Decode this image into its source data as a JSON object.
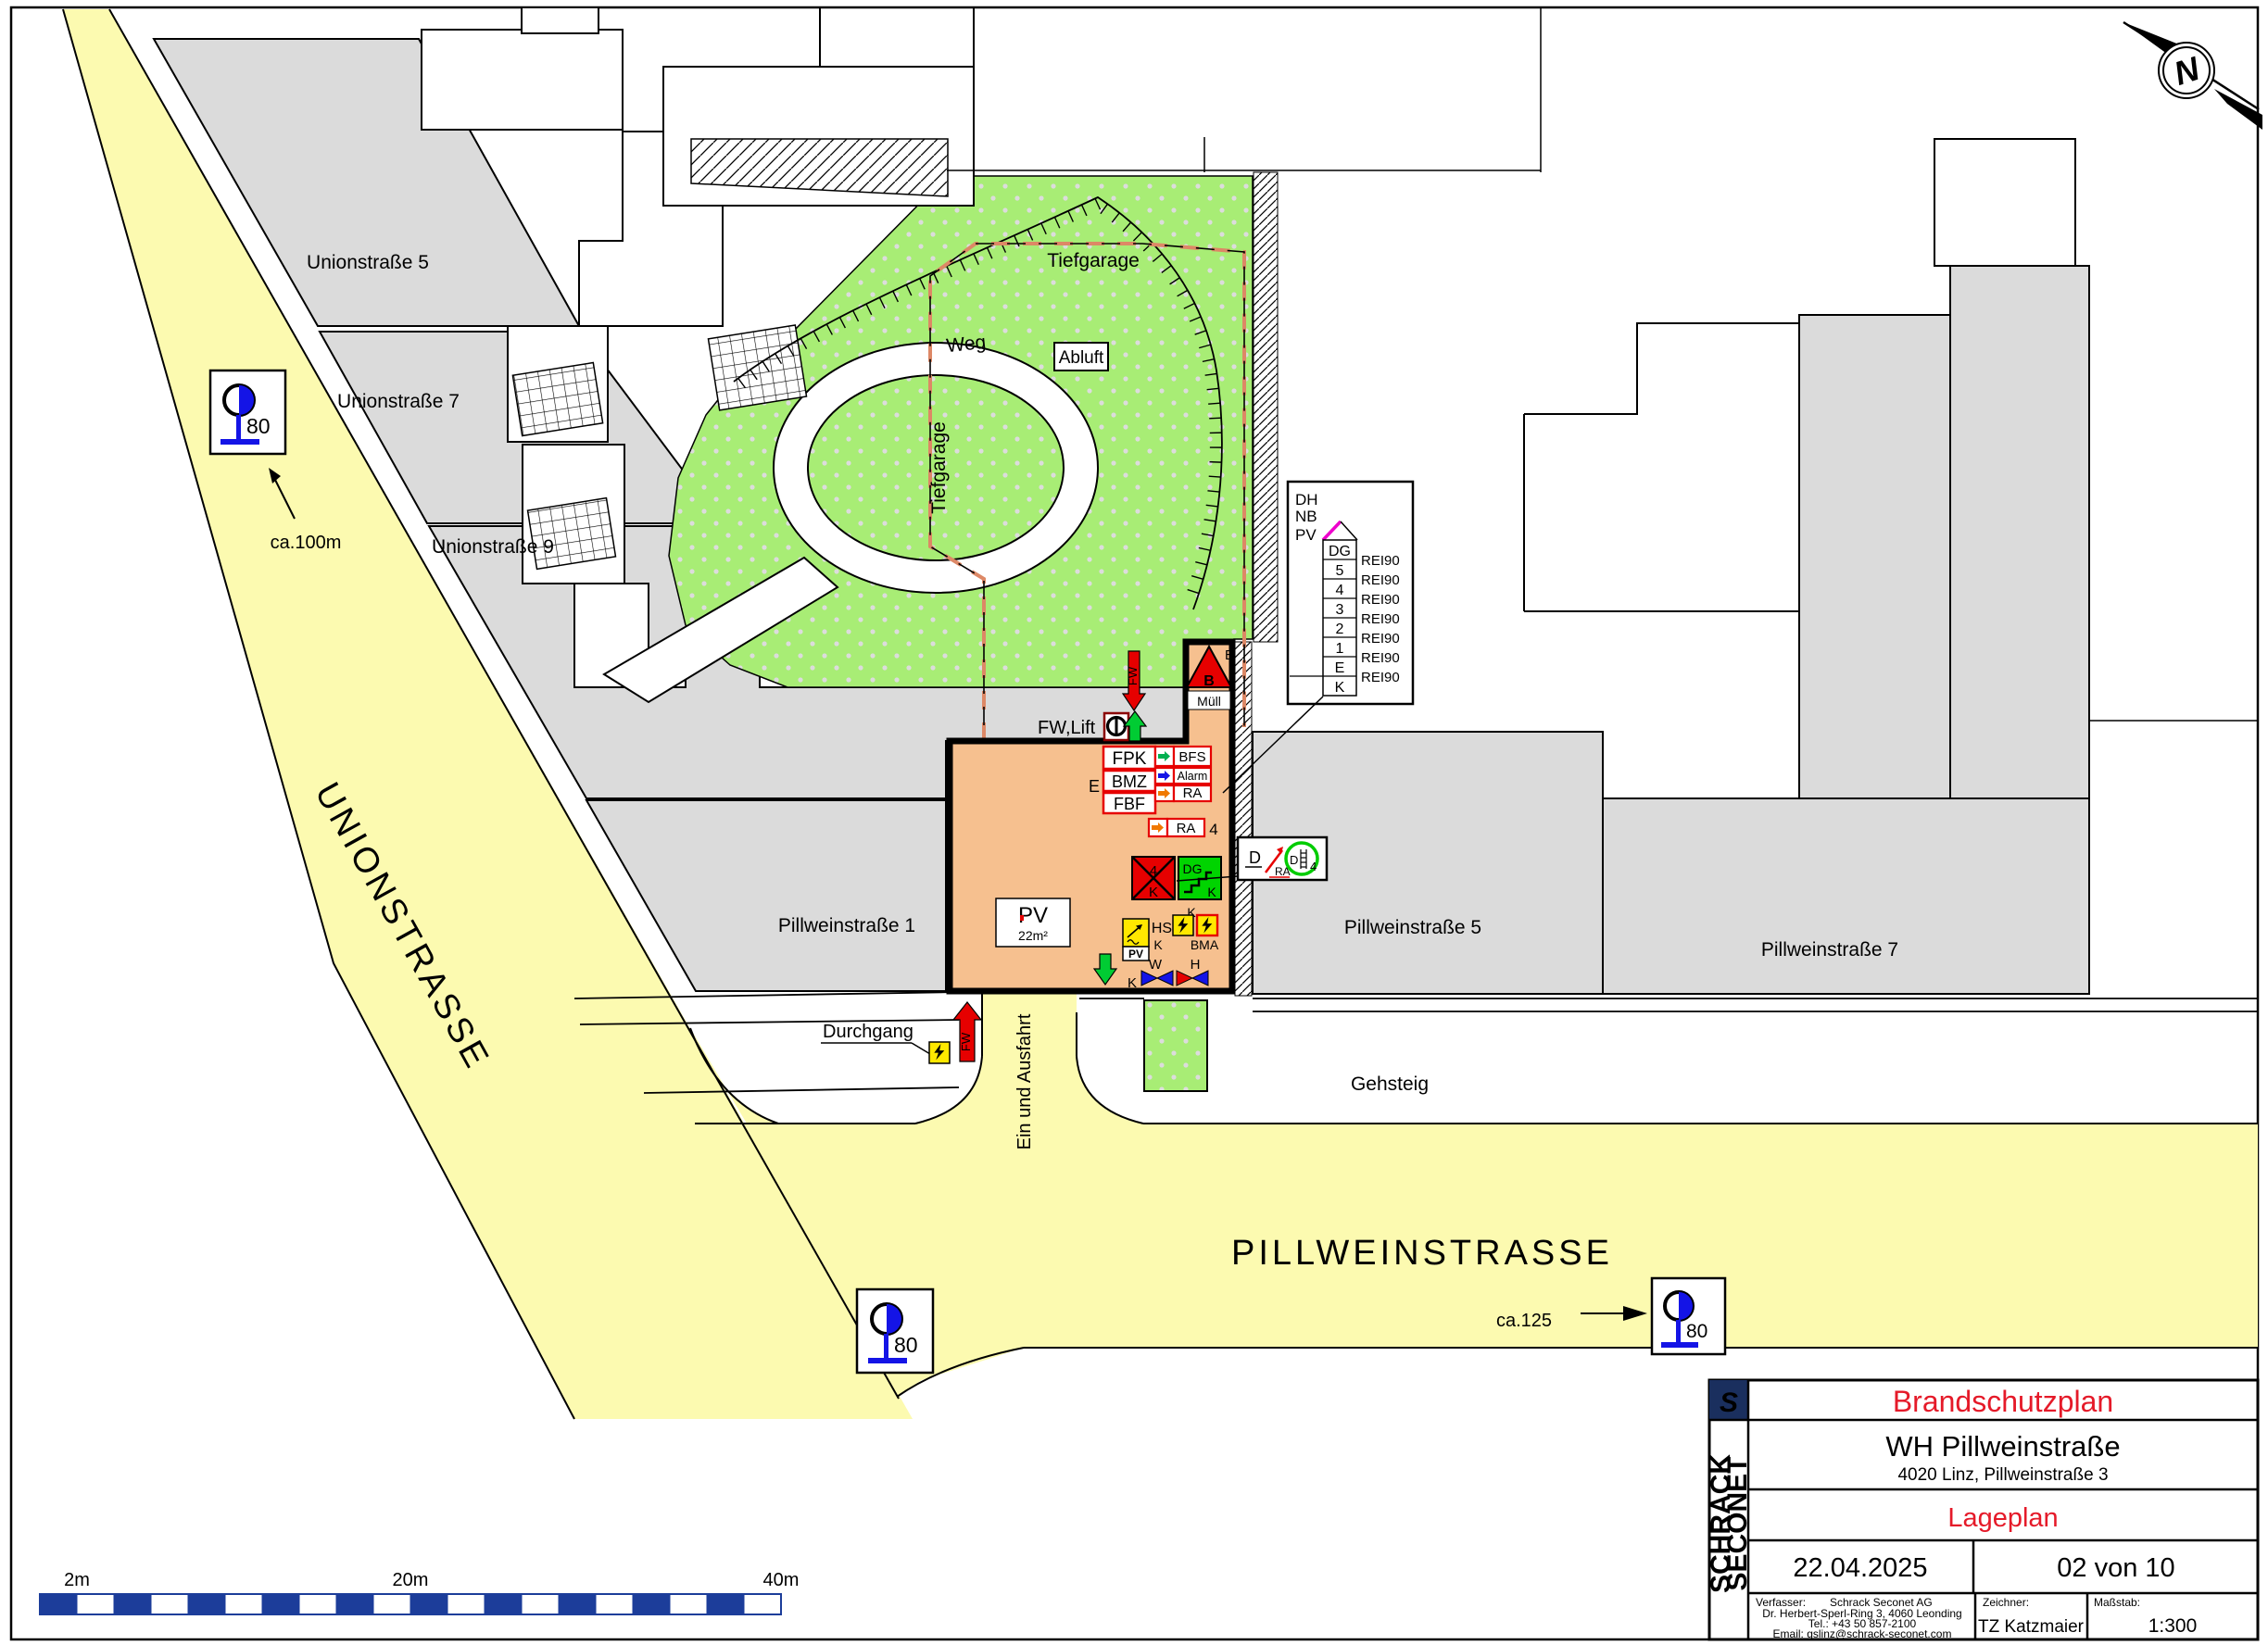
{
  "streets": {
    "unionstrasse": "UNIONSTRASSE",
    "pillweinstrasse": "PILLWEINSTRASSE",
    "gehsteig": "Gehsteig",
    "ein_und_ausfahrt": "Ein und Ausfahrt",
    "durchgang": "Durchgang",
    "weg": "Weg"
  },
  "plots": {
    "u5": "Unionstraße 5",
    "u7": "Unionstraße 7",
    "u9": "Unionstraße 9",
    "p1": "Pillweinstraße 1",
    "p5": "Pillweinstraße 5",
    "p7": "Pillweinstraße 7",
    "tiefgarage_top": "Tiefgarage",
    "tiefgarage_side": "Tiefgarage",
    "abluft": "Abluft"
  },
  "hydrants": {
    "h1_label": "80",
    "h1_distance": "ca.100m",
    "h2_label": "80",
    "h3_label": "80",
    "h3_distance": "ca.125"
  },
  "building": {
    "fw_lift": "FW,Lift",
    "fw_down": "FW",
    "fw_entry": "FW",
    "e_entry": "E",
    "fpk": "FPK",
    "bmz": "BMZ",
    "fbf": "FBF",
    "bfs": "BFS",
    "alarm": "Alarm",
    "ra": "RA",
    "ra2": "RA",
    "ra2_count": "4",
    "box4": "4",
    "box4_k": "K",
    "dg": "DG",
    "dg_k": "K",
    "k_shaft": "K",
    "hs": "HS",
    "hs_k": "K",
    "bma": "BMA",
    "pv_small": "PV",
    "valve_w": "W",
    "valve_h": "H",
    "valve_k": "K",
    "pv_area": "PV",
    "pv_area_size": "22m²",
    "muell": "Müll",
    "b_alarm": "B",
    "e_exit": "E"
  },
  "legend": {
    "d": "D",
    "ra": "RA",
    "d_circle": "D",
    "d_count": "4"
  },
  "section": {
    "dh": "DH",
    "nb": "NB",
    "pv": "PV",
    "floors": [
      "DG",
      "5",
      "4",
      "3",
      "2",
      "1",
      "E",
      "K"
    ],
    "ratings": [
      "REI90",
      "REI90",
      "REI90",
      "REI90",
      "REI90",
      "REI90",
      "REI90"
    ]
  },
  "scale_bar": {
    "m2": "2m",
    "m20": "20m",
    "m40": "40m"
  },
  "north": {
    "letter": "N"
  },
  "title_block": {
    "logo_letter": "S",
    "brand_top": "SCHRACK",
    "brand_bottom": "SECONET",
    "doc_type": "Brandschutzplan",
    "project": "WH Pillweinstraße",
    "address": "4020 Linz, Pillweinstraße 3",
    "sheet_name": "Lageplan",
    "date": "22.04.2025",
    "page_info": "02 von 10",
    "author_label": "Verfasser:",
    "author_name": "Schrack Seconet AG",
    "author_addr": "Dr. Herbert-Sperl-Ring 3, 4060 Leonding",
    "author_tel": "Tel.: +43 50 857-2100",
    "author_email": "Email: gslinz@schrack-seconet.com",
    "drawer_label": "Zeichner:",
    "drawer": "TZ Katzmaier",
    "scale_label": "Maßstab:",
    "scale": "1:300"
  }
}
